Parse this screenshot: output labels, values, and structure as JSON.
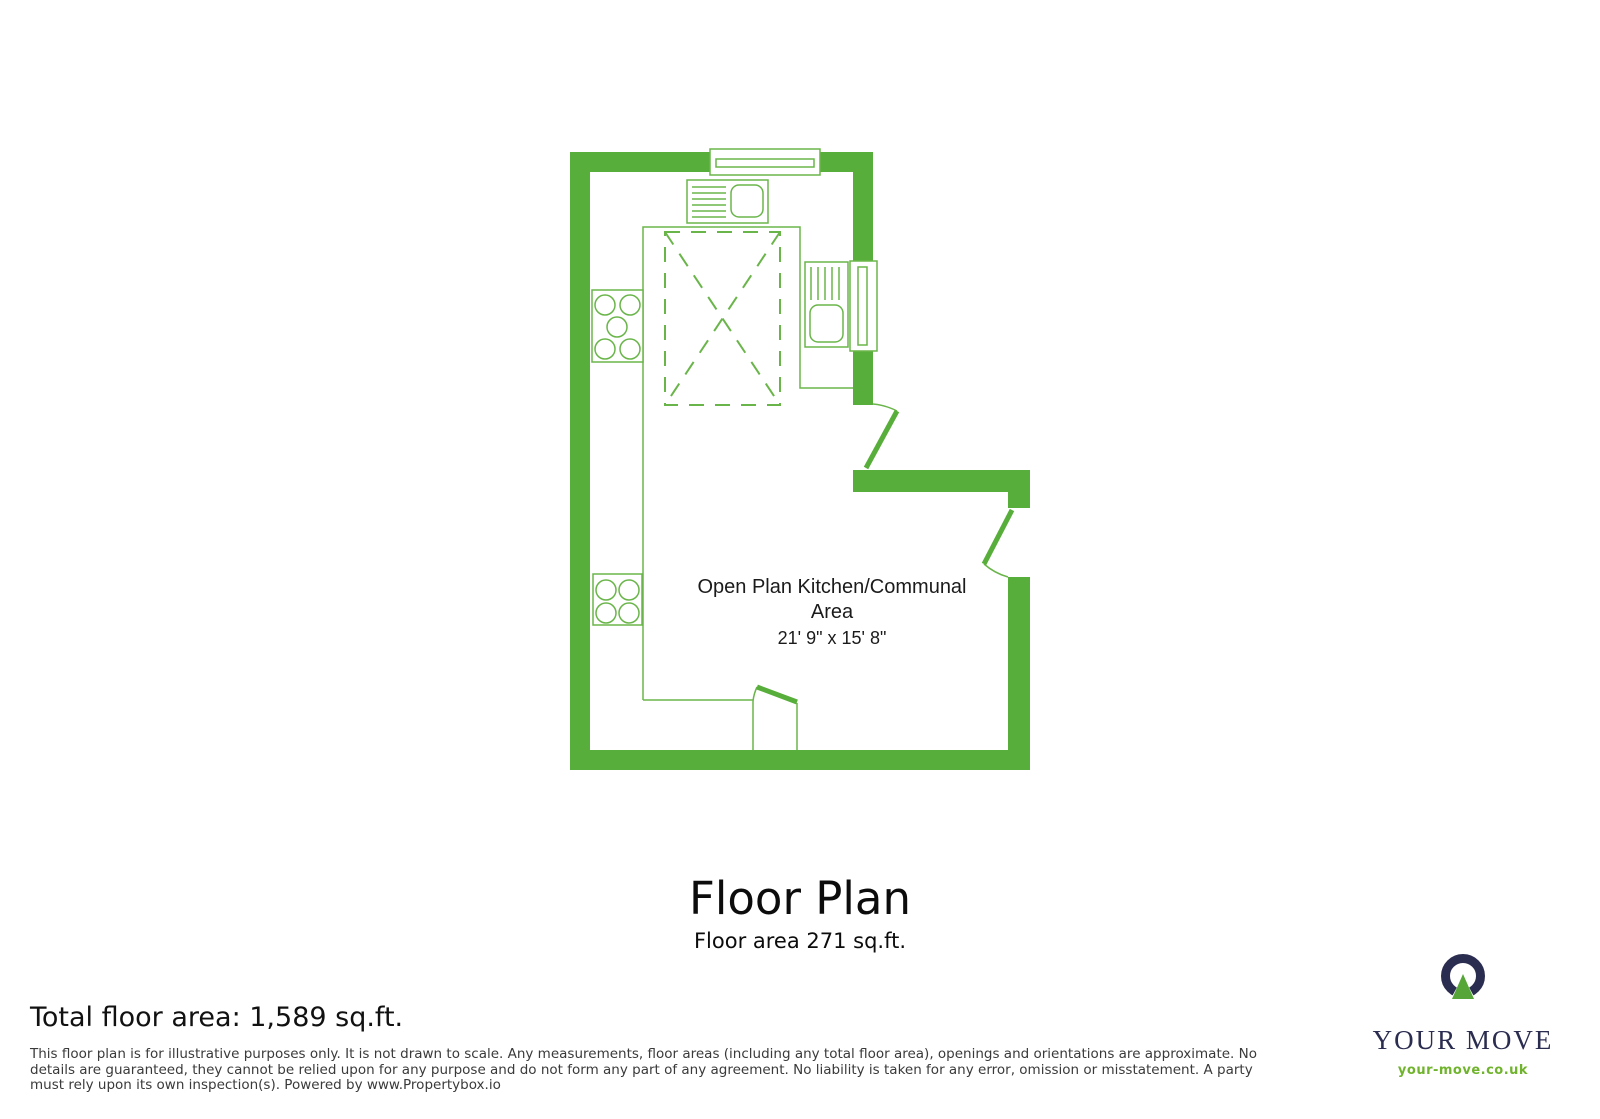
{
  "plan": {
    "room": {
      "name": "Open Plan Kitchen/Communal Area",
      "dimensions": "21' 9\" x 15' 8\""
    },
    "icons": {
      "windows": "white-rect-double-line",
      "doors": "quarter-arc-with-leaf",
      "hob": "five-burner-circles",
      "appliance": "four-circle-washer",
      "sink_units": "drainer-lines-with-basin",
      "vaulted_area": "dashed-rect-with-diagonals"
    }
  },
  "titles": {
    "title": "Floor Plan",
    "subtitle": "Floor area 271 sq.ft.",
    "total_area": "Total floor area: 1,589 sq.ft."
  },
  "disclaimer": "This floor plan is for illustrative purposes only. It is not drawn to scale. Any measurements, floor areas (including any total floor area), openings and orientations are approximate. No details are guaranteed, they cannot be relied upon for any purpose and do not form any part of any agreement. No liability is taken for any error, omission or misstatement. A party must rely upon its own inspection(s). Powered by www.Propertybox.io",
  "logo": {
    "name": "YOUR MOVE",
    "url": "your-move.co.uk",
    "mark": "your-move-logo-mark"
  },
  "colors": {
    "wall_green": "#58ae3a",
    "fixture_line_green": "#6ab54a",
    "logo_navy": "#2b2d50",
    "logo_triangle_green": "#55a538",
    "logo_url_green": "#70b32d"
  }
}
